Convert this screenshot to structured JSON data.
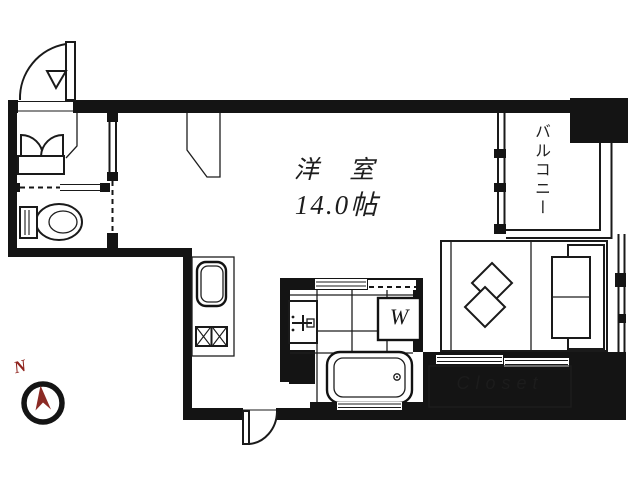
{
  "plan": {
    "room": {
      "label": "洋 室",
      "size": "14.0帖"
    },
    "balcony": {
      "label": "バルコニー"
    },
    "washing_machine": {
      "label": "W"
    },
    "closet": {
      "label": "Closet"
    },
    "compass": {
      "label": "N"
    }
  },
  "colors": {
    "wall": "#141414",
    "floor": "#ffffff",
    "compass_needle": "#8b2a24",
    "north_label": "#8f231d"
  },
  "fixtures": [
    "entrance-door",
    "shoe-cabinet",
    "toilet",
    "entry-window",
    "kitchen-sink",
    "gas-stove",
    "washbasin",
    "washing-machine",
    "bathtub",
    "bed",
    "cushions",
    "sofa",
    "closet-sliding-door",
    "balcony-window",
    "balcony-railing",
    "bottom-door",
    "compass"
  ]
}
